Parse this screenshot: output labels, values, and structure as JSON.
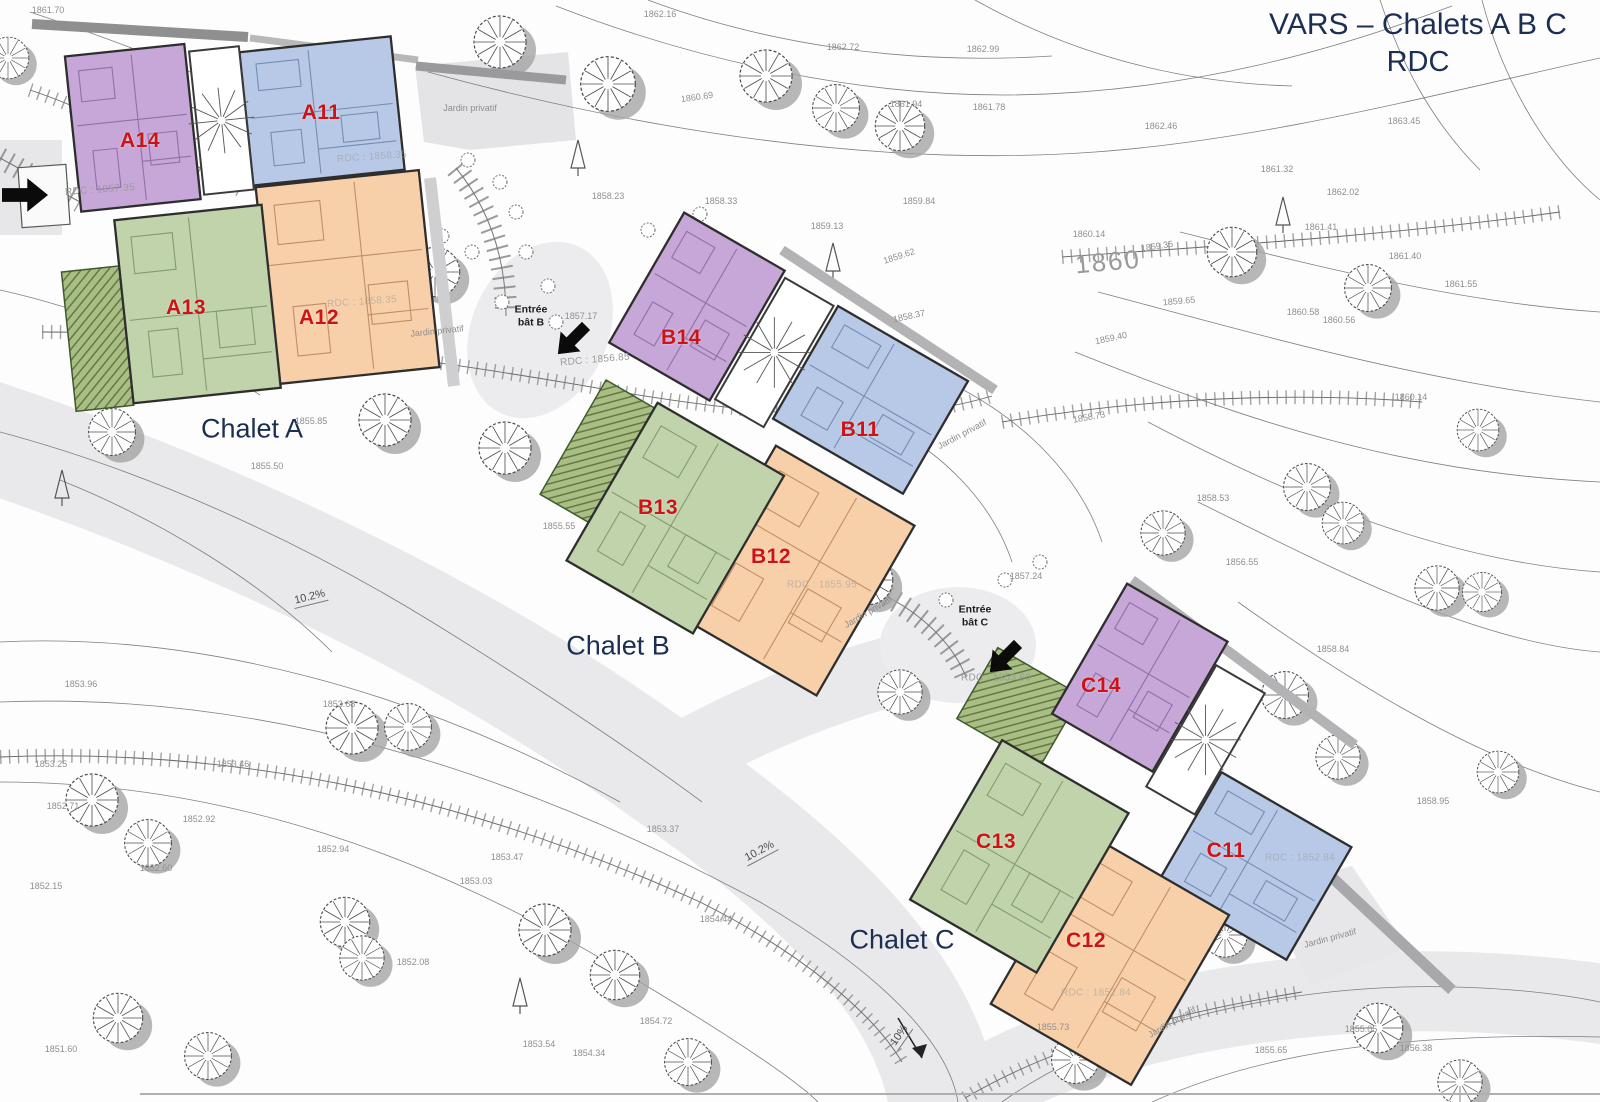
{
  "title": {
    "line1": "VARS – Chalets A B C",
    "line2": "RDC"
  },
  "palette": {
    "purple": "#c7a7d8",
    "purple_edge": "#5a3a78",
    "blue": "#b7c9e7",
    "blue_edge": "#34527f",
    "green": "#c1d3aa",
    "green_edge": "#49633b",
    "orange": "#f7d0aa",
    "orange_edge": "#8a4e22",
    "unit_label": "#ce1317",
    "chalet_label": "#1c2f52",
    "wall": "#2e2e2e",
    "terrain_text": "#8f8f8f",
    "road": "#e9e9ec"
  },
  "chalet_labels": [
    {
      "text": "Chalet A",
      "x": 252,
      "y": 429
    },
    {
      "text": "Chalet B",
      "x": 618,
      "y": 646
    },
    {
      "text": "Chalet C",
      "x": 902,
      "y": 940
    }
  ],
  "units": [
    {
      "id": "A14",
      "color": "purple",
      "x": 140,
      "y": 141
    },
    {
      "id": "A11",
      "color": "blue",
      "x": 321,
      "y": 113
    },
    {
      "id": "A13",
      "color": "green",
      "x": 186,
      "y": 308
    },
    {
      "id": "A12",
      "color": "orange",
      "x": 319,
      "y": 318
    },
    {
      "id": "B14",
      "color": "purple",
      "x": 681,
      "y": 338
    },
    {
      "id": "B11",
      "color": "blue",
      "x": 860,
      "y": 430
    },
    {
      "id": "B13",
      "color": "green",
      "x": 658,
      "y": 508
    },
    {
      "id": "B12",
      "color": "orange",
      "x": 771,
      "y": 557
    },
    {
      "id": "C14",
      "color": "purple",
      "x": 1101,
      "y": 686
    },
    {
      "id": "C13",
      "color": "green",
      "x": 996,
      "y": 842
    },
    {
      "id": "C11",
      "color": "blue",
      "x": 1226,
      "y": 851
    },
    {
      "id": "C12",
      "color": "orange",
      "x": 1086,
      "y": 941
    }
  ],
  "entrances": [
    {
      "line1": "Entrée",
      "line2": "bât B",
      "x": 531,
      "y": 316,
      "arrow": {
        "x": 552,
        "y": 324,
        "rot": 135
      }
    },
    {
      "line1": "Entrée",
      "line2": "bât C",
      "x": 975,
      "y": 616,
      "arrow": {
        "x": 984,
        "y": 642,
        "rot": 135
      }
    }
  ],
  "site_arrow": {
    "x": 2,
    "y": 176,
    "rot": 0
  },
  "slope_labels": [
    {
      "text": "10.2%",
      "x": 310,
      "y": 598,
      "rot": -14
    },
    {
      "text": "10.2%",
      "x": 760,
      "y": 852,
      "rot": -28
    },
    {
      "text": "10%",
      "x": 900,
      "y": 1036,
      "rot": -55
    }
  ],
  "contour_label": {
    "text": "1860",
    "x": 1108,
    "y": 262,
    "rot": -5
  },
  "garden_label": "Jardin privatif",
  "garden_spots": [
    {
      "x": 470,
      "y": 108,
      "rot": 0
    },
    {
      "x": 437,
      "y": 331,
      "rot": -6
    },
    {
      "x": 962,
      "y": 434,
      "rot": -28
    },
    {
      "x": 868,
      "y": 612,
      "rot": -30
    },
    {
      "x": 1330,
      "y": 938,
      "rot": -15
    },
    {
      "x": 1172,
      "y": 1022,
      "rot": -30
    }
  ],
  "rdc_labels": [
    {
      "text": "RDC : 1857.35",
      "x": 100,
      "y": 190,
      "rot": -4,
      "faint": false
    },
    {
      "text": "RDC : 1856.85",
      "x": 595,
      "y": 360,
      "rot": -5,
      "faint": false
    },
    {
      "text": "RDC : 1853.60",
      "x": 996,
      "y": 678,
      "rot": 0,
      "faint": false
    },
    {
      "text": "RDC : 1858.35",
      "x": 372,
      "y": 157,
      "rot": -4,
      "faint": true
    },
    {
      "text": "RDC : 1858.35",
      "x": 362,
      "y": 302,
      "rot": -4,
      "faint": true
    },
    {
      "text": "RDC : 1855.95",
      "x": 822,
      "y": 585,
      "rot": 0,
      "faint": true
    },
    {
      "text": "RDC : 1852.84",
      "x": 1300,
      "y": 858,
      "rot": 0,
      "faint": true
    },
    {
      "text": "RDC : 1852.84",
      "x": 1096,
      "y": 993,
      "rot": 0,
      "faint": true
    }
  ],
  "elevations": [
    {
      "t": "1861.70",
      "x": 48,
      "y": 10
    },
    {
      "t": "1862.16",
      "x": 660,
      "y": 14
    },
    {
      "t": "1862.72",
      "x": 843,
      "y": 47
    },
    {
      "t": "1862.99",
      "x": 983,
      "y": 49
    },
    {
      "t": "1860.69",
      "x": 697,
      "y": 97,
      "r": -8
    },
    {
      "t": "1861.94",
      "x": 906,
      "y": 104
    },
    {
      "t": "1861.78",
      "x": 989,
      "y": 107
    },
    {
      "t": "1862.46",
      "x": 1161,
      "y": 126
    },
    {
      "t": "1863.45",
      "x": 1404,
      "y": 121
    },
    {
      "t": "1861.32",
      "x": 1277,
      "y": 169
    },
    {
      "t": "1862.02",
      "x": 1343,
      "y": 192
    },
    {
      "t": "1861.41",
      "x": 1321,
      "y": 227
    },
    {
      "t": "1861.40",
      "x": 1405,
      "y": 256
    },
    {
      "t": "1860.14",
      "x": 1089,
      "y": 234
    },
    {
      "t": "1859.35",
      "x": 1157,
      "y": 246,
      "r": -8
    },
    {
      "t": "1859.65",
      "x": 1179,
      "y": 301,
      "r": -5
    },
    {
      "t": "1860.58",
      "x": 1303,
      "y": 312
    },
    {
      "t": "1861.55",
      "x": 1461,
      "y": 284
    },
    {
      "t": "1860.56",
      "x": 1339,
      "y": 320
    },
    {
      "t": "1859.40",
      "x": 1111,
      "y": 338,
      "r": -12
    },
    {
      "t": "1858.73",
      "x": 1089,
      "y": 417,
      "r": -10
    },
    {
      "t": "1860.14",
      "x": 1411,
      "y": 397
    },
    {
      "t": "1858.23",
      "x": 608,
      "y": 196
    },
    {
      "t": "1858.33",
      "x": 721,
      "y": 201
    },
    {
      "t": "1859.84",
      "x": 919,
      "y": 201
    },
    {
      "t": "1859.13",
      "x": 827,
      "y": 226
    },
    {
      "t": "1859.62",
      "x": 899,
      "y": 256,
      "r": -18
    },
    {
      "t": "1858.37",
      "x": 909,
      "y": 316,
      "r": -12
    },
    {
      "t": "1857.17",
      "x": 581,
      "y": 316
    },
    {
      "t": "1858.53",
      "x": 1213,
      "y": 498
    },
    {
      "t": "1856.55",
      "x": 1242,
      "y": 562
    },
    {
      "t": "1855.85",
      "x": 311,
      "y": 421
    },
    {
      "t": "1855.50",
      "x": 267,
      "y": 466
    },
    {
      "t": "1855.55",
      "x": 559,
      "y": 526
    },
    {
      "t": "1857.24",
      "x": 1026,
      "y": 576
    },
    {
      "t": "1858.84",
      "x": 1333,
      "y": 649
    },
    {
      "t": "1858.95",
      "x": 1433,
      "y": 801
    },
    {
      "t": "1853.96",
      "x": 81,
      "y": 684
    },
    {
      "t": "1853.68",
      "x": 339,
      "y": 704
    },
    {
      "t": "1853.25",
      "x": 51,
      "y": 764
    },
    {
      "t": "1853.46",
      "x": 233,
      "y": 764
    },
    {
      "t": "1852.92",
      "x": 199,
      "y": 819
    },
    {
      "t": "1852.71",
      "x": 63,
      "y": 806
    },
    {
      "t": "1852.60",
      "x": 156,
      "y": 868
    },
    {
      "t": "1852.15",
      "x": 46,
      "y": 886
    },
    {
      "t": "1853.03",
      "x": 476,
      "y": 881
    },
    {
      "t": "1852.94",
      "x": 333,
      "y": 849
    },
    {
      "t": "1853.37",
      "x": 663,
      "y": 829
    },
    {
      "t": "1853.47",
      "x": 507,
      "y": 857
    },
    {
      "t": "1854.44",
      "x": 716,
      "y": 919
    },
    {
      "t": "1852.08",
      "x": 413,
      "y": 962
    },
    {
      "t": "1851.60",
      "x": 61,
      "y": 1049
    },
    {
      "t": "1853.54",
      "x": 539,
      "y": 1044
    },
    {
      "t": "1854.34",
      "x": 589,
      "y": 1053
    },
    {
      "t": "1854.72",
      "x": 656,
      "y": 1021
    },
    {
      "t": "1855.73",
      "x": 1053,
      "y": 1027
    },
    {
      "t": "1855.05",
      "x": 1361,
      "y": 1029
    },
    {
      "t": "1855.65",
      "x": 1271,
      "y": 1050
    },
    {
      "t": "1856.38",
      "x": 1416,
      "y": 1048
    }
  ]
}
